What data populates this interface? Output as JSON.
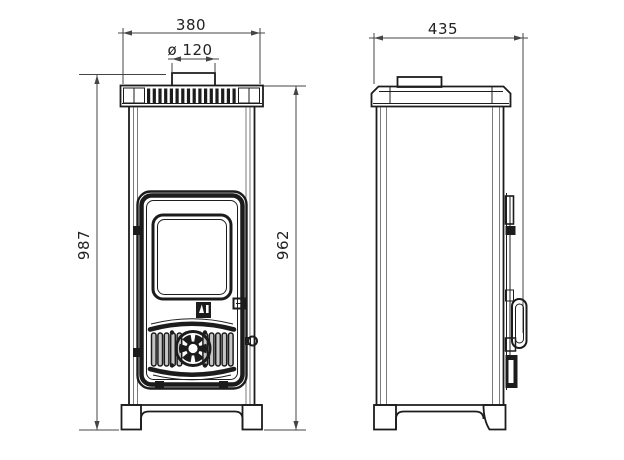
{
  "meta": {
    "type": "technical-line-drawing",
    "subject": "wood-burning stove, front and side orthographic views with dimensions",
    "colors": {
      "background": "#ffffff",
      "line": "#1c1c1c",
      "dimension": "#454545"
    }
  },
  "dimensions": {
    "front_top_width": "380",
    "flue_diameter": "ø 120",
    "overall_height": "987",
    "body_height": "962",
    "side_depth": "435"
  }
}
